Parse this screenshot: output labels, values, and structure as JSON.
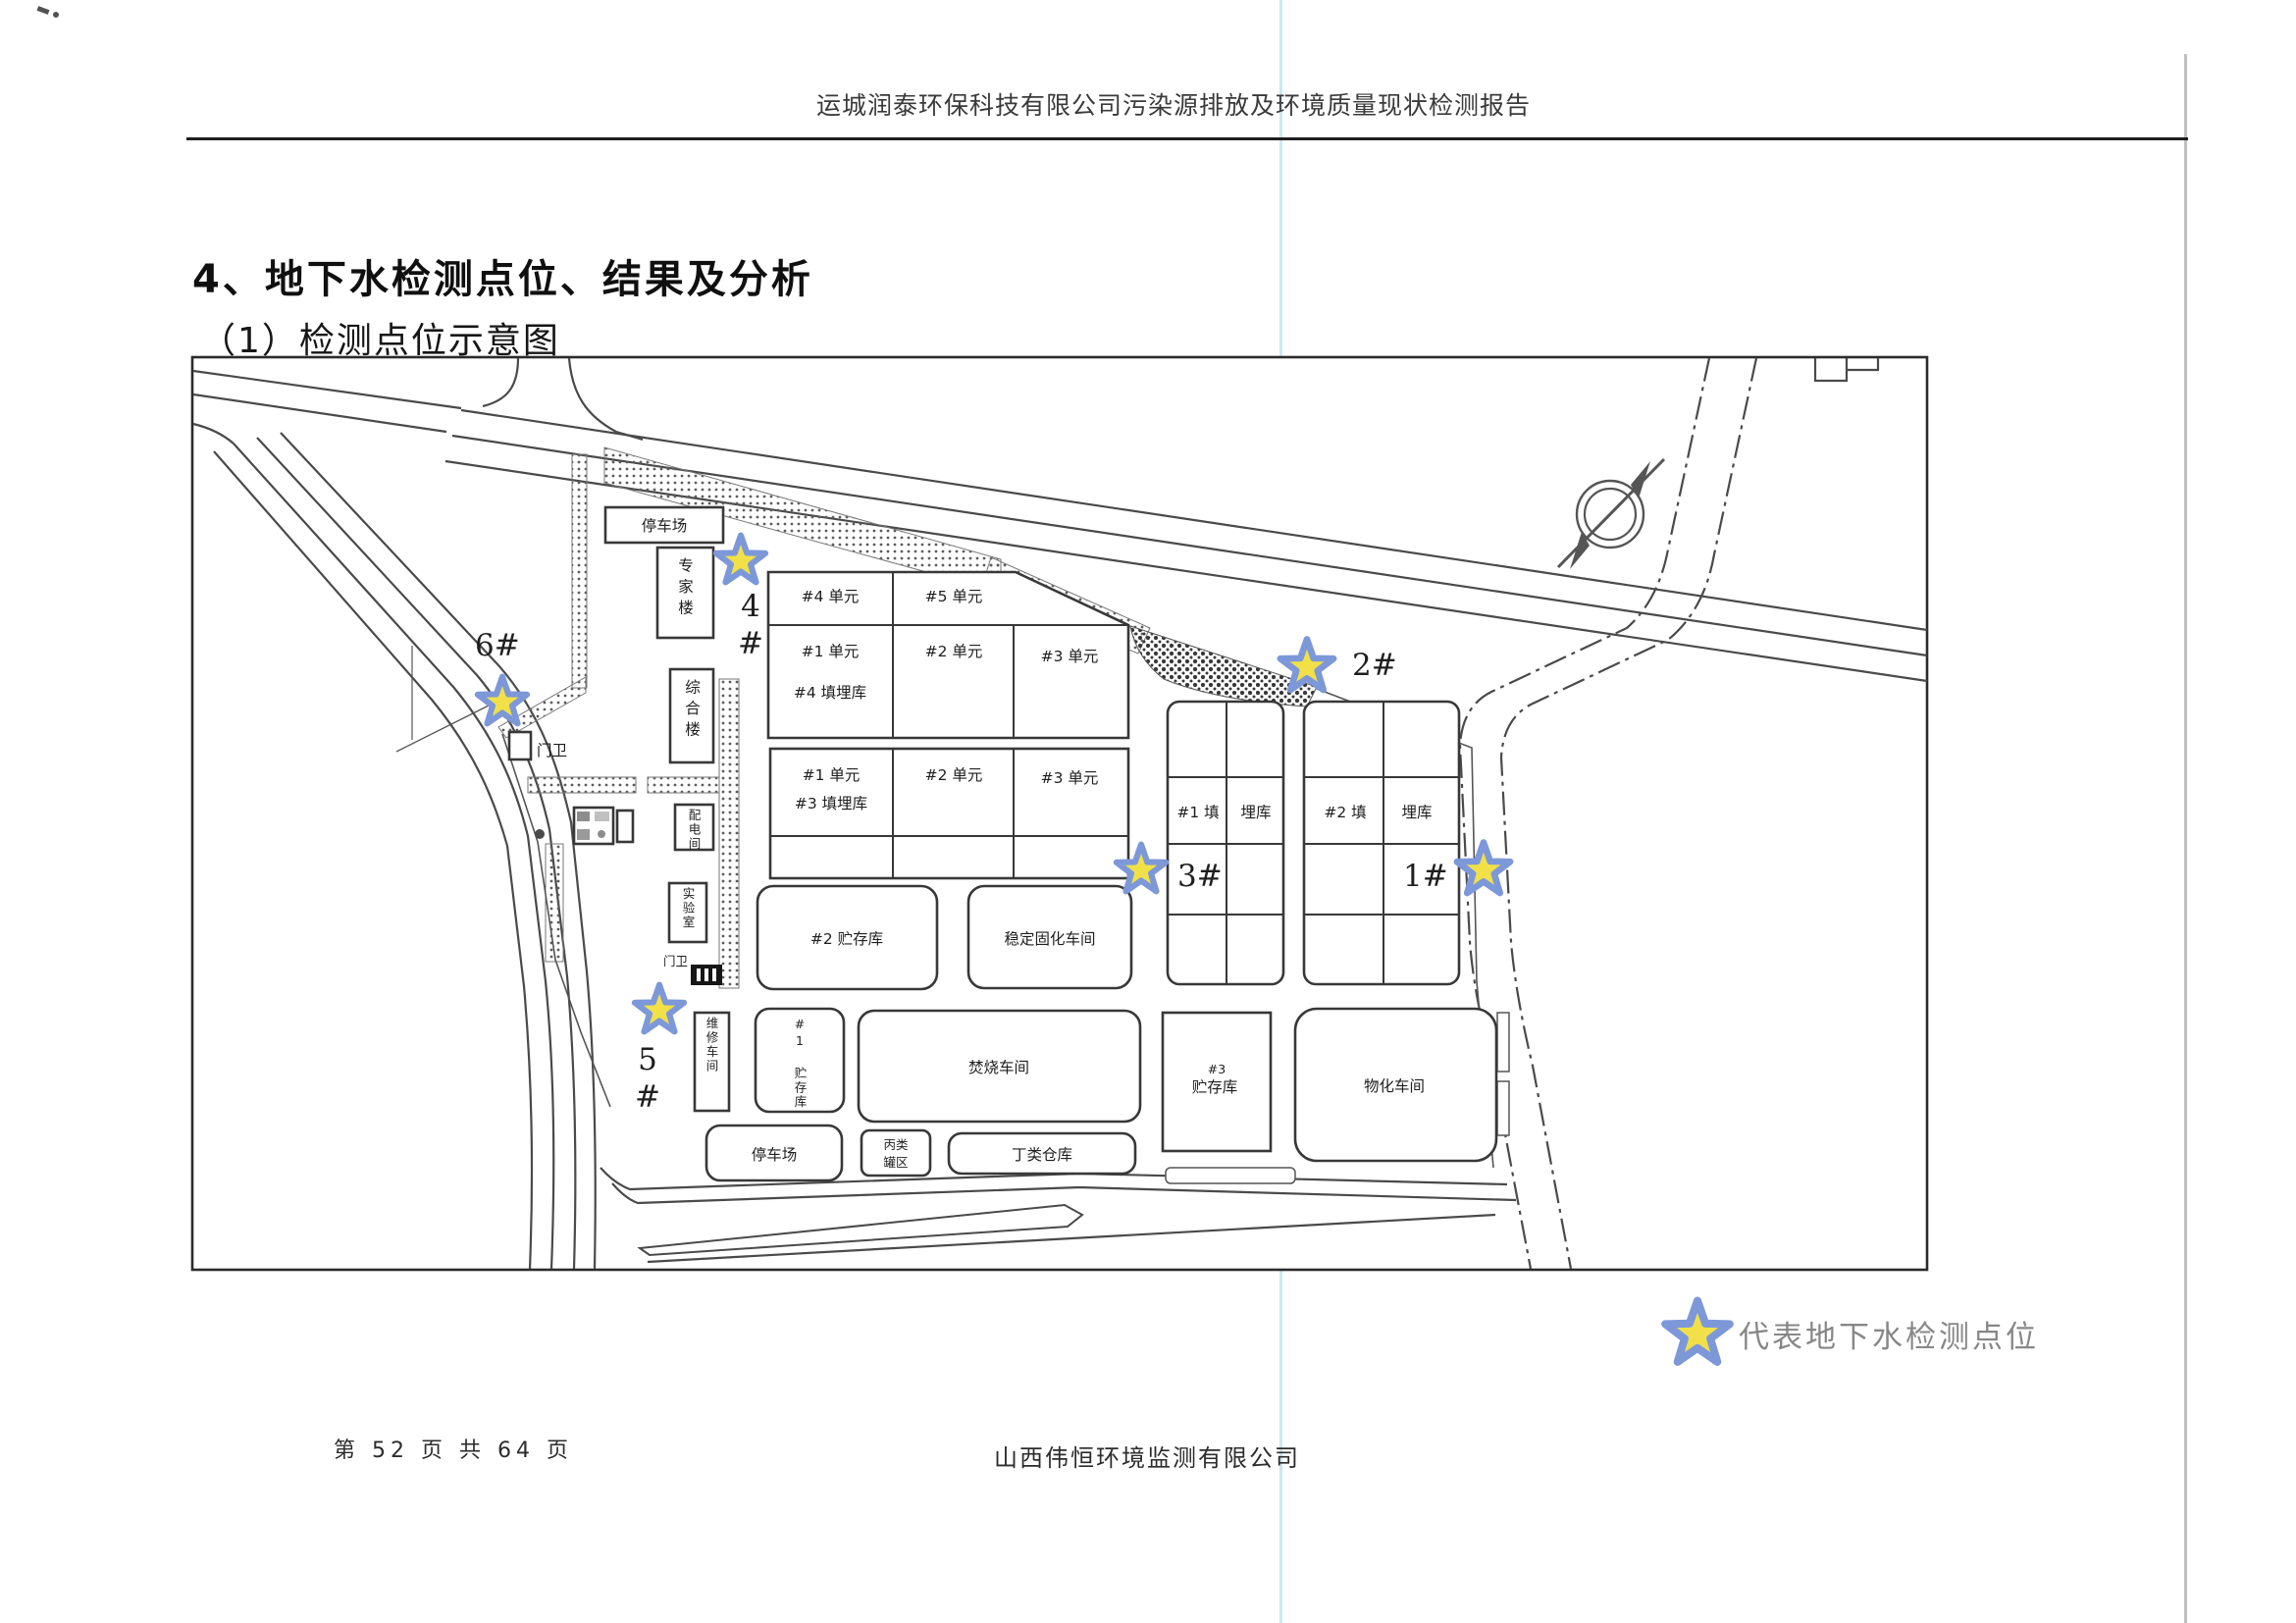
{
  "page": {
    "header": "运城润泰环保科技有限公司污染源排放及环境质量现状检测报告",
    "title": "4、地下水检测点位、结果及分析",
    "subtitle": "（1）检测点位示意图",
    "footer_left": "第 52 页 共 64 页",
    "footer_center": "山西伟恒环境监测有限公司"
  },
  "map": {
    "buildings": {
      "parking_top": "停车场",
      "expert_bldg": "专家楼",
      "office_bldg": "综合楼",
      "gate_house_1": "门卫",
      "power_room": "配电间",
      "lab": "实验室",
      "gate_house_2": "门卫",
      "unit4": "#4 单元",
      "unit5": "#5 单元",
      "u_row2_1": "#1 单元",
      "u_row2_2": "#2 单元",
      "u_row2_3": "#3 单元",
      "landfill4": "#4 填埋库",
      "l_row_1": "#1 单元",
      "l_row_2": "#2 单元",
      "l_row_3": "#3 单元",
      "landfill3": "#3 填埋库",
      "east1_a": "#1 填",
      "east1_b": "埋库",
      "east2_a": "#2 填",
      "east2_b": "埋库",
      "storage2": "#2 贮存库",
      "solidification": "稳定固化车间",
      "repair_shop": "维修车间",
      "storage1": "#1 贮存库",
      "incineration": "焚烧车间",
      "parking_bottom": "停车场",
      "tank_a": "丙类",
      "tank_b": "罐区",
      "warehouse_d": "丁类仓库",
      "storage3_a": "#3",
      "storage3_b": "贮存库",
      "physchem": "物化车间"
    },
    "points": {
      "p1": "1#",
      "p2": "2#",
      "p3": "3#",
      "p4": "4#",
      "p5": "5#",
      "p6": "6#"
    },
    "legend_label": "代表地下水检测点位",
    "colors": {
      "star_fill": "#f2e049",
      "star_stroke": "#7d98d9",
      "point_label": "#e64560"
    }
  }
}
